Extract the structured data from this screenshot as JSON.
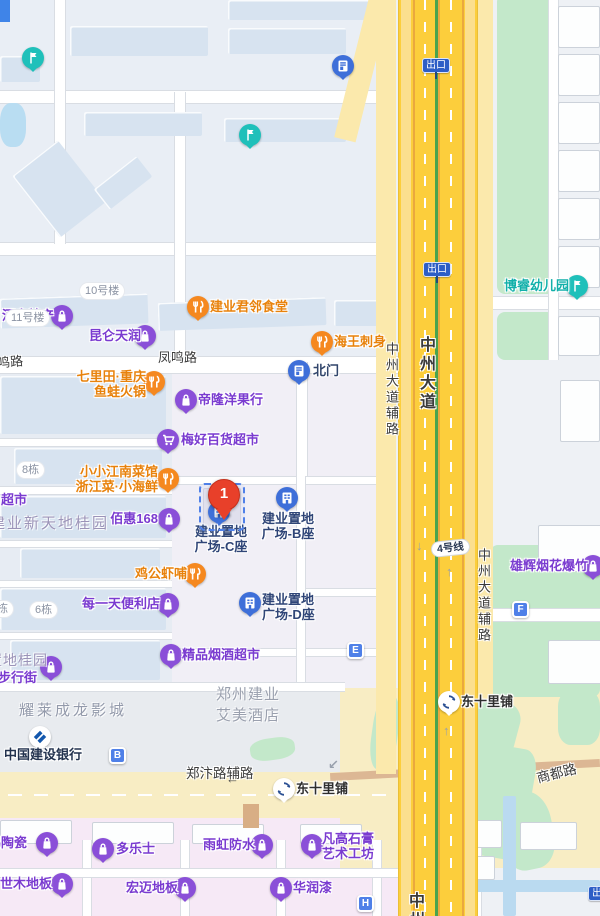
{
  "colors": {
    "poi_purple": "#7a3bd0",
    "poi_orange": "#e8820c",
    "poi_navy": "#2f4577",
    "poi_teal": "#12b0aa",
    "poi_dark": "#2e2e2e",
    "bank_navy": "#22324e",
    "highway_yellow": "#fcce3c",
    "service_yellow": "#fbe9ac",
    "surface_yellow": "#f8edc4",
    "green_area": "#c3e8ca",
    "pink_area": "#f6e9f6",
    "marker_blue": "#4f80e8",
    "red_pin": "#e8402a",
    "area_gray": "#939aab",
    "area_purple_gray": "#9b93b8"
  },
  "selected_pin": {
    "number": "1",
    "x": 223,
    "y": 479
  },
  "dashed_box": {
    "x": 199,
    "y": 483,
    "w": 42,
    "h": 44
  },
  "road_labels": [
    {
      "text": "凤鸣路",
      "x": 158,
      "y": 347,
      "size": 13
    },
    {
      "text": "凤鸣路",
      "x": -16,
      "y": 352,
      "size": 13,
      "rot": -5
    },
    {
      "text": "郑汴路辅路",
      "x": 186,
      "y": 762,
      "size": 13.5
    },
    {
      "text": "商都路",
      "x": 536,
      "y": 762,
      "size": 13.5,
      "rot": -14
    },
    {
      "text": "中州大道辅路",
      "x": 382,
      "y": 342,
      "size": 13,
      "vertical": true
    },
    {
      "text": "中州大道",
      "x": 413,
      "y": 336,
      "size": 16,
      "vertical": true,
      "bold": true
    },
    {
      "text": "中州大道辅路",
      "x": 474,
      "y": 548,
      "size": 13,
      "vertical": true
    },
    {
      "text": "中州",
      "x": 402,
      "y": 892,
      "size": 16,
      "vertical": true,
      "bold": true
    }
  ],
  "area_labels": [
    {
      "lines": [
        "建业新天地桂园"
      ],
      "x": -10,
      "y": 512,
      "size": 15,
      "ls": 2,
      "color": "#9b93b8"
    },
    {
      "lines": [
        "置地桂园"
      ],
      "x": -12,
      "y": 650,
      "size": 14,
      "ls": 1,
      "color": "#9b93b8"
    },
    {
      "lines": [
        "耀莱成龙影城"
      ],
      "x": 19,
      "y": 699,
      "size": 15,
      "ls": 3,
      "color": "#939aab"
    },
    {
      "lines": [
        "郑州建业",
        "艾美酒店"
      ],
      "x": 216,
      "y": 683,
      "size": 15,
      "ls": 1,
      "color": "#9aa0ae"
    }
  ],
  "building_pills": [
    {
      "text": "11号楼",
      "x": 6,
      "y": 310
    },
    {
      "text": "10号楼",
      "x": 80,
      "y": 283
    },
    {
      "text": "8栋",
      "x": 17,
      "y": 462
    },
    {
      "text": "6栋",
      "x": 30,
      "y": 602
    },
    {
      "text": "栋",
      "x": -8,
      "y": 601
    }
  ],
  "exit_signs": [
    {
      "text": "出口",
      "x": 422,
      "y": 58
    },
    {
      "text": "出口",
      "x": 423,
      "y": 262
    },
    {
      "text": "出口",
      "x": 588,
      "y": 886
    }
  ],
  "metro_line_pill": {
    "text": "4号线",
    "x": 431,
    "y": 540,
    "rot": -6
  },
  "letter_markers": [
    {
      "letter": "B",
      "x": 109,
      "y": 747
    },
    {
      "letter": "E",
      "x": 347,
      "y": 642
    },
    {
      "letter": "F",
      "x": 512,
      "y": 601
    },
    {
      "letter": "H",
      "x": 357,
      "y": 895
    }
  ],
  "arrows": [
    {
      "glyph": "↓",
      "x": 416,
      "y": 538,
      "color": "#98a0ad"
    },
    {
      "glyph": "↑",
      "x": 446,
      "y": 564,
      "color": "#98a0ad"
    },
    {
      "glyph": "↑",
      "x": 443,
      "y": 723,
      "color": "#98a0ad"
    },
    {
      "glyph": "←",
      "x": 226,
      "y": 771,
      "color": "#4a4a4a"
    },
    {
      "glyph": "↙",
      "x": 328,
      "y": 757,
      "color": "#98a0ad"
    }
  ],
  "pois": [
    {
      "id": "henan-techan",
      "type": "shop",
      "icon": [
        62,
        316
      ],
      "lines": [
        "河南特产"
      ],
      "lx": 2,
      "ly": 308,
      "w": 56,
      "align": "left"
    },
    {
      "id": "kunlun-tianrun",
      "type": "shop",
      "icon": [
        145,
        336
      ],
      "lines": [
        "昆仑天润"
      ],
      "lx": 85,
      "ly": 328,
      "w": 56,
      "align": "right"
    },
    {
      "id": "jianye-canteen",
      "type": "rest",
      "icon": [
        198,
        307
      ],
      "lines": [
        "建业君邻食堂"
      ],
      "lx": 210,
      "ly": 299,
      "w": 80,
      "align": "left"
    },
    {
      "id": "haiwang-sashimi",
      "type": "rest",
      "icon": [
        322,
        342
      ],
      "lines": [
        "海王刺身"
      ],
      "lx": 334,
      "ly": 334,
      "w": 56,
      "align": "left"
    },
    {
      "id": "north-gate",
      "type": "door",
      "icon": [
        299,
        371
      ],
      "lines": [
        "北门"
      ],
      "lx": 313,
      "ly": 363,
      "w": 30,
      "align": "left",
      "color": "#31456b"
    },
    {
      "id": "qilitian-hotpot",
      "type": "rest",
      "icon": [
        154,
        382
      ],
      "lines": [
        "七里田·重庆",
        "鱼蛙火锅"
      ],
      "lx": 64,
      "ly": 369,
      "w": 82,
      "align": "right"
    },
    {
      "id": "dilong-fruit",
      "type": "shop",
      "icon": [
        186,
        400
      ],
      "lines": [
        "帝隆洋果行"
      ],
      "lx": 198,
      "ly": 392,
      "w": 70,
      "align": "left"
    },
    {
      "id": "meihao-supermarket",
      "type": "cart",
      "icon": [
        168,
        440
      ],
      "lines": [
        "梅好百货超市"
      ],
      "lx": 181,
      "ly": 432,
      "w": 80,
      "align": "left"
    },
    {
      "id": "xiaoxiao-jiangnan",
      "type": "rest",
      "icon": [
        168,
        479
      ],
      "lines": [
        "小小江南菜馆",
        "浙江菜·小海鲜"
      ],
      "lx": 74,
      "ly": 464,
      "w": 84,
      "align": "right"
    },
    {
      "id": "chaoshi-partial",
      "type": "none",
      "lines": [
        "超市"
      ],
      "lx": 1,
      "ly": 492,
      "w": 30,
      "align": "left"
    },
    {
      "id": "baihui-168",
      "type": "shop",
      "icon": [
        169,
        519
      ],
      "lines": [
        "佰惠168"
      ],
      "lx": 110,
      "ly": 511,
      "w": 48,
      "align": "right"
    },
    {
      "id": "jianye-plaza-c",
      "type": "bldg",
      "icon": [
        219,
        512
      ],
      "lines": [
        "建业置地",
        "广场-C座"
      ],
      "lx": 194,
      "ly": 524,
      "w": 54,
      "align": "center",
      "color": "#2f4577"
    },
    {
      "id": "jianye-plaza-b",
      "type": "bldg",
      "icon": [
        287,
        498
      ],
      "lines": [
        "建业置地",
        "广场-B座"
      ],
      "lx": 260,
      "ly": 511,
      "w": 56,
      "align": "center",
      "color": "#2f4577"
    },
    {
      "id": "jianye-plaza-d",
      "type": "bldg",
      "icon": [
        250,
        603
      ],
      "lines": [
        "建业置地",
        "广场-D座"
      ],
      "lx": 262,
      "ly": 592,
      "w": 58,
      "align": "left",
      "color": "#2f4577"
    },
    {
      "id": "jigong-shrimp",
      "type": "rest",
      "icon": [
        195,
        574
      ],
      "lines": [
        "鸡公虾哺"
      ],
      "lx": 131,
      "ly": 566,
      "w": 56,
      "align": "right"
    },
    {
      "id": "meiyitian-store",
      "type": "shop",
      "icon": [
        168,
        604
      ],
      "lines": [
        "每一天便利店"
      ],
      "lx": 80,
      "ly": 596,
      "w": 80,
      "align": "right"
    },
    {
      "id": "jingpin-tobacco",
      "type": "shop",
      "icon": [
        171,
        655
      ],
      "lines": [
        "精品烟酒超市"
      ],
      "lx": 182,
      "ly": 647,
      "w": 80,
      "align": "left"
    },
    {
      "id": "walking-street",
      "type": "shop",
      "icon": [
        51,
        667
      ],
      "lines": [
        "步行街"
      ],
      "lx": -2,
      "ly": 670,
      "w": 44,
      "align": "left"
    },
    {
      "id": "ccb-bank",
      "type": "bank",
      "icon": [
        40,
        737
      ],
      "lines": [
        "中国建设银行"
      ],
      "lx": 4,
      "ly": 747,
      "w": 80,
      "align": "left",
      "color": "#22324e"
    },
    {
      "id": "xionghui-fireworks",
      "type": "shop",
      "icon": [
        593,
        566
      ],
      "lines": [
        "雄辉烟花爆竹"
      ],
      "lx": 508,
      "ly": 558,
      "w": 80,
      "align": "right"
    },
    {
      "id": "borui-kindergarten",
      "type": "flag",
      "icon": [
        577,
        286
      ],
      "lines": [
        "博睿幼儿园"
      ],
      "lx": 501,
      "ly": 278,
      "w": 68,
      "align": "right",
      "color": "#12b0aa"
    },
    {
      "id": "dongshilipu-station-1",
      "type": "metro",
      "icon": [
        449,
        702
      ],
      "lines": [
        "东十里铺"
      ],
      "lx": 461,
      "ly": 694,
      "w": 56,
      "align": "left",
      "color": "#2e2e2e"
    },
    {
      "id": "dongshilipu-station-2",
      "type": "metro",
      "icon": [
        284,
        789
      ],
      "lines": [
        "东十里铺"
      ],
      "lx": 296,
      "ly": 781,
      "w": 56,
      "align": "left",
      "color": "#2e2e2e"
    },
    {
      "id": "peng-ceramics",
      "type": "shop",
      "icon": [
        47,
        843
      ],
      "lines": [
        "鹏陶瓷"
      ],
      "lx": -12,
      "ly": 835,
      "w": 46,
      "align": "left"
    },
    {
      "id": "duoleshi",
      "type": "shop",
      "icon": [
        103,
        849
      ],
      "lines": [
        "多乐士"
      ],
      "lx": 116,
      "ly": 841,
      "w": 42,
      "align": "left"
    },
    {
      "id": "yuhong-waterproof",
      "type": "shop",
      "icon": [
        262,
        845
      ],
      "lines": [
        "雨虹防水"
      ],
      "lx": 199,
      "ly": 837,
      "w": 56,
      "align": "right"
    },
    {
      "id": "fangao-gypsum",
      "type": "shop",
      "icon": [
        312,
        845
      ],
      "lines": [
        "凡高石膏",
        "艺术工坊"
      ],
      "lx": 322,
      "ly": 831,
      "w": 56,
      "align": "left"
    },
    {
      "id": "shimu-flooring",
      "type": "shop",
      "icon": [
        62,
        884
      ],
      "lines": [
        "世木地板"
      ],
      "lx": 0,
      "ly": 876,
      "w": 54,
      "align": "left"
    },
    {
      "id": "hongmai-flooring",
      "type": "shop",
      "icon": [
        185,
        888
      ],
      "lines": [
        "宏迈地板"
      ],
      "lx": 120,
      "ly": 880,
      "w": 58,
      "align": "right"
    },
    {
      "id": "huarun-paint",
      "type": "shop",
      "icon": [
        281,
        888
      ],
      "lines": [
        "华润漆"
      ],
      "lx": 293,
      "ly": 880,
      "w": 44,
      "align": "left"
    }
  ],
  "plain_pins": [
    {
      "id": "teal-pin-1",
      "type": "flag",
      "icon": [
        33,
        58
      ]
    },
    {
      "id": "teal-pin-2",
      "type": "flag",
      "icon": [
        250,
        135
      ]
    },
    {
      "id": "gate-pin-top",
      "type": "door",
      "icon": [
        343,
        66
      ]
    }
  ]
}
